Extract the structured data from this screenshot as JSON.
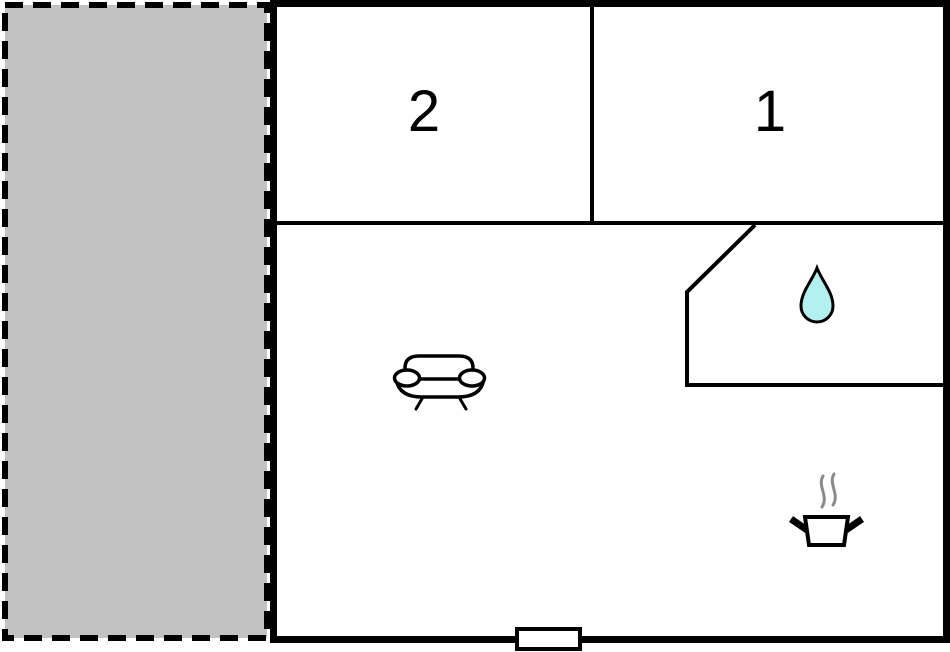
{
  "floorplan": {
    "rooms": [
      {
        "id": "room-2",
        "label": "2"
      },
      {
        "id": "room-1",
        "label": "1"
      }
    ],
    "areas": {
      "terrace": "terrace",
      "living_area": "living-area",
      "bathroom": "bathroom",
      "kitchen": "kitchen"
    },
    "icons": [
      {
        "name": "sofa-icon"
      },
      {
        "name": "water-drop-icon"
      },
      {
        "name": "cooking-pot-icon"
      },
      {
        "name": "steam-icon"
      }
    ],
    "colors": {
      "wall": "#000000",
      "terrace_fill": "#c2c2c2",
      "room_fill": "#ffffff",
      "water_drop_fill": "#b3f1f1",
      "water_drop_stroke": "#000000",
      "steam": "#8a8a8a",
      "door_fill": "#ffffff"
    }
  }
}
